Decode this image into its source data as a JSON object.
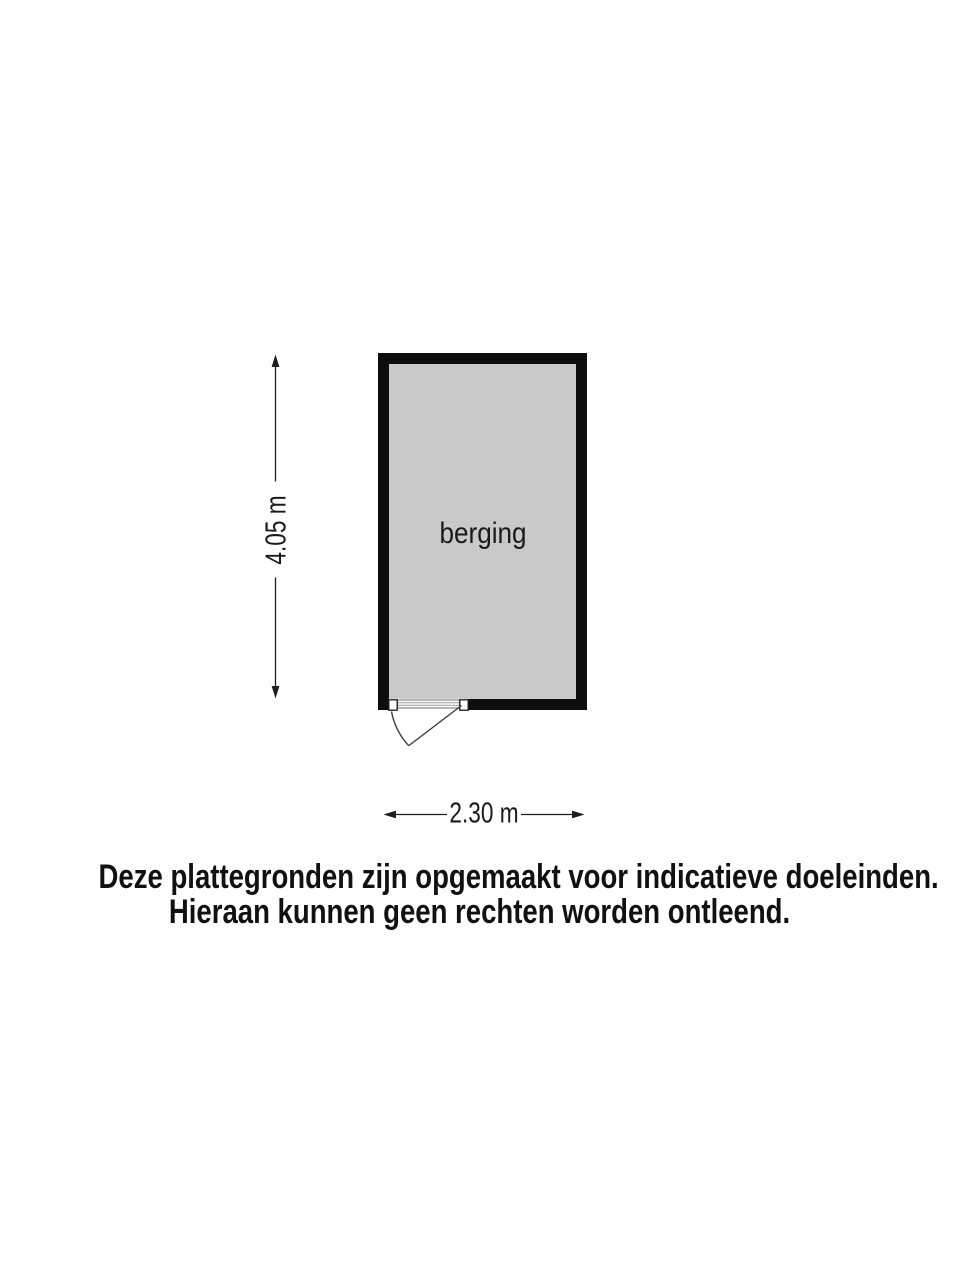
{
  "floorplan": {
    "room": {
      "label": "berging"
    },
    "dimensions": {
      "height": "4.05 m",
      "width": "2.30 m"
    },
    "colors": {
      "wall": "#0d0d0d",
      "floor": "#c9c9c9",
      "line": "#1e1e1e",
      "door": "#3d3d3d",
      "background": "#ffffff"
    }
  },
  "disclaimer": {
    "line1": "Deze plattegronden zijn opgemaakt voor indicatieve doeleinden.",
    "line2": "Hieraan kunnen geen rechten worden ontleend."
  }
}
